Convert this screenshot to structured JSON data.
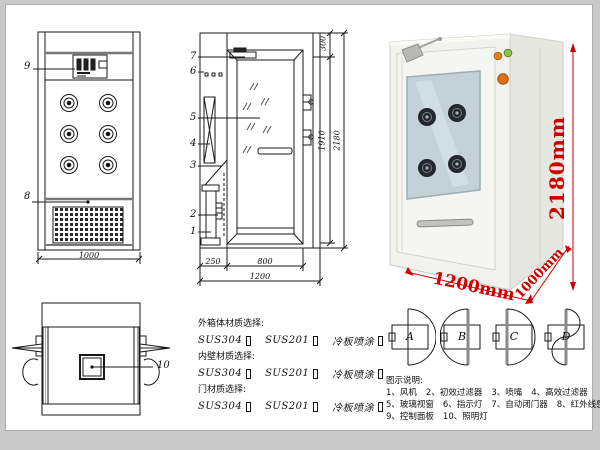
{
  "views": {
    "front": {
      "label_9": "9",
      "label_8": "8",
      "dim_width": "1000"
    },
    "side": {
      "label_1": "1",
      "label_2": "2",
      "label_3": "3",
      "label_4": "4",
      "label_5": "5",
      "label_6": "6",
      "label_7": "7",
      "dim_back": "250",
      "dim_door": "800",
      "dim_total_width": "1200",
      "dim_top": "300",
      "dim_inner_height": "1910",
      "dim_total_height": "2180"
    },
    "top": {
      "label_10": "10"
    }
  },
  "photo": {
    "dim_height": "2180mm",
    "dim_width": "1200mm",
    "dim_depth": "1000mm"
  },
  "door_options": {
    "labels": [
      "A",
      "B",
      "C",
      "D"
    ]
  },
  "materials": {
    "sections": [
      {
        "title": "外箱体材质选择:"
      },
      {
        "title": "内壁材质选择:"
      },
      {
        "title": "门材质选择:"
      }
    ],
    "opt1": "SUS304",
    "opt2": "SUS201",
    "opt3": "冷板喷涂"
  },
  "legend": {
    "title": "图示说明:",
    "items": [
      "1、风机",
      "2、初效过滤器",
      "3、喷嘴",
      "4、高效过滤器",
      "5、玻璃视窗",
      "6、指示灯",
      "7、自动闭门器",
      "8、红外线感应器",
      "9、控制面板",
      "10、照明灯"
    ]
  },
  "colors": {
    "line": "#1a1a1a",
    "dim_red": "#cc0000",
    "glass": "#c4d2d8",
    "indicator_green": "#8bc34a",
    "indicator_orange": "#e2801e"
  }
}
